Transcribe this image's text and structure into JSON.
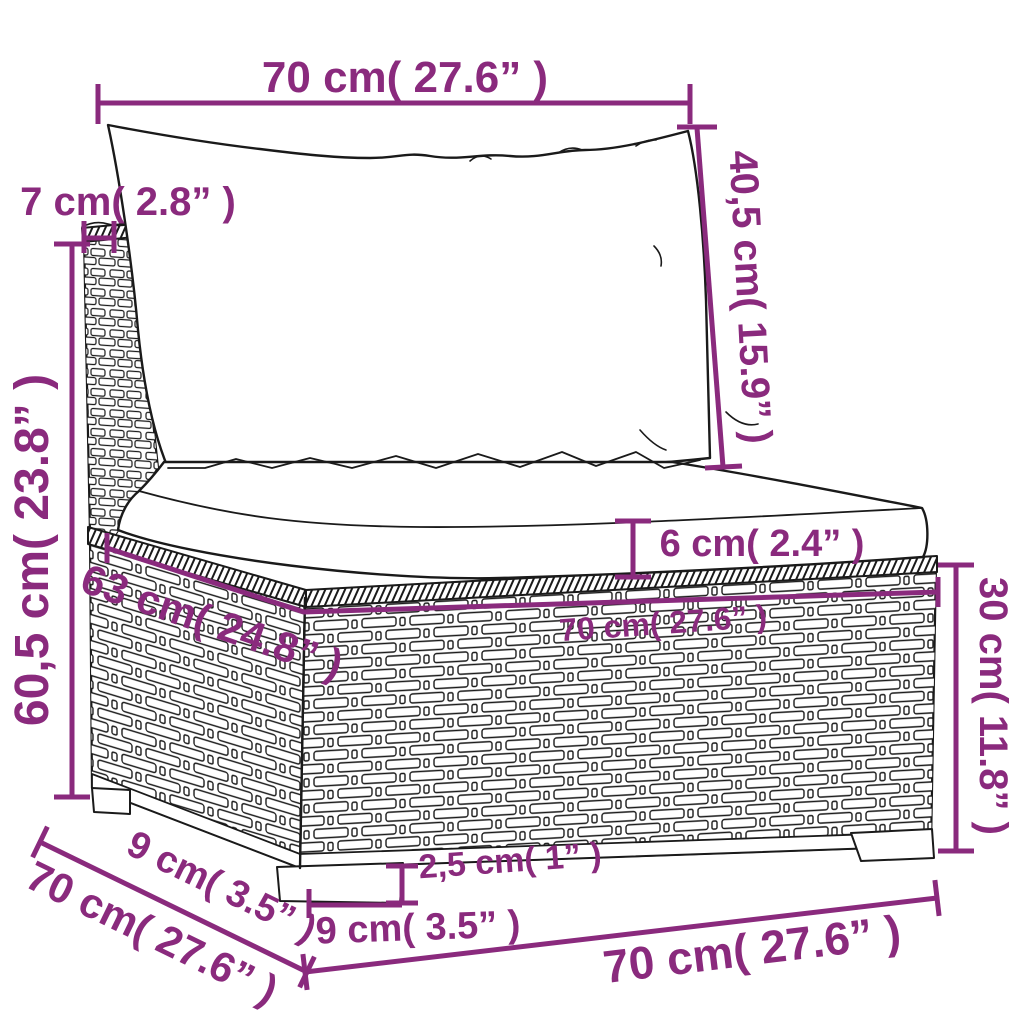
{
  "description": "Hand-drawn dimension diagram of a poly rattan garden sofa middle section with a back cushion and a seat cushion",
  "colors": {
    "dimension": "#8a2a7d",
    "line_art": "#1a1a1a",
    "background": "#ffffff"
  },
  "dimensions": {
    "top_width": {
      "label": "70 cm( 27.6” )",
      "value_cm": "70",
      "value_in": "27.6"
    },
    "back_post_depth": {
      "label": "7 cm( 2.8” )",
      "value_cm": "7",
      "value_in": "2.8"
    },
    "back_cushion_height": {
      "label": "40,5 cm( 15.9” )",
      "value_cm": "40,5",
      "value_in": "15.9"
    },
    "total_height": {
      "label": "60,5 cm( 23.8” )",
      "value_cm": "60,5",
      "value_in": "23.8"
    },
    "seat_cushion_thickness": {
      "label": "6 cm( 2.4” )",
      "value_cm": "6",
      "value_in": "2.4"
    },
    "seat_width": {
      "label": "70 cm( 27.6” )",
      "value_cm": "70",
      "value_in": "27.6"
    },
    "seat_depth": {
      "label": "63 cm( 24.8” )",
      "value_cm": "63",
      "value_in": "24.8"
    },
    "base_height": {
      "label": "30 cm( 11.8” )",
      "value_cm": "30",
      "value_in": "11.8"
    },
    "leg_height": {
      "label": "2,5 cm( 1” )",
      "value_cm": "2,5",
      "value_in": "1"
    },
    "leg_inset_front": {
      "label": "9 cm( 3.5” )",
      "value_cm": "9",
      "value_in": "3.5"
    },
    "leg_inset_side": {
      "label": "9 cm( 3.5” )",
      "value_cm": "9",
      "value_in": "3.5"
    },
    "side_depth": {
      "label": "70 cm( 27.6” )",
      "value_cm": "70",
      "value_in": "27.6"
    },
    "bottom_width": {
      "label": "70 cm( 27.6” )",
      "value_cm": "70",
      "value_in": "27.6"
    }
  }
}
